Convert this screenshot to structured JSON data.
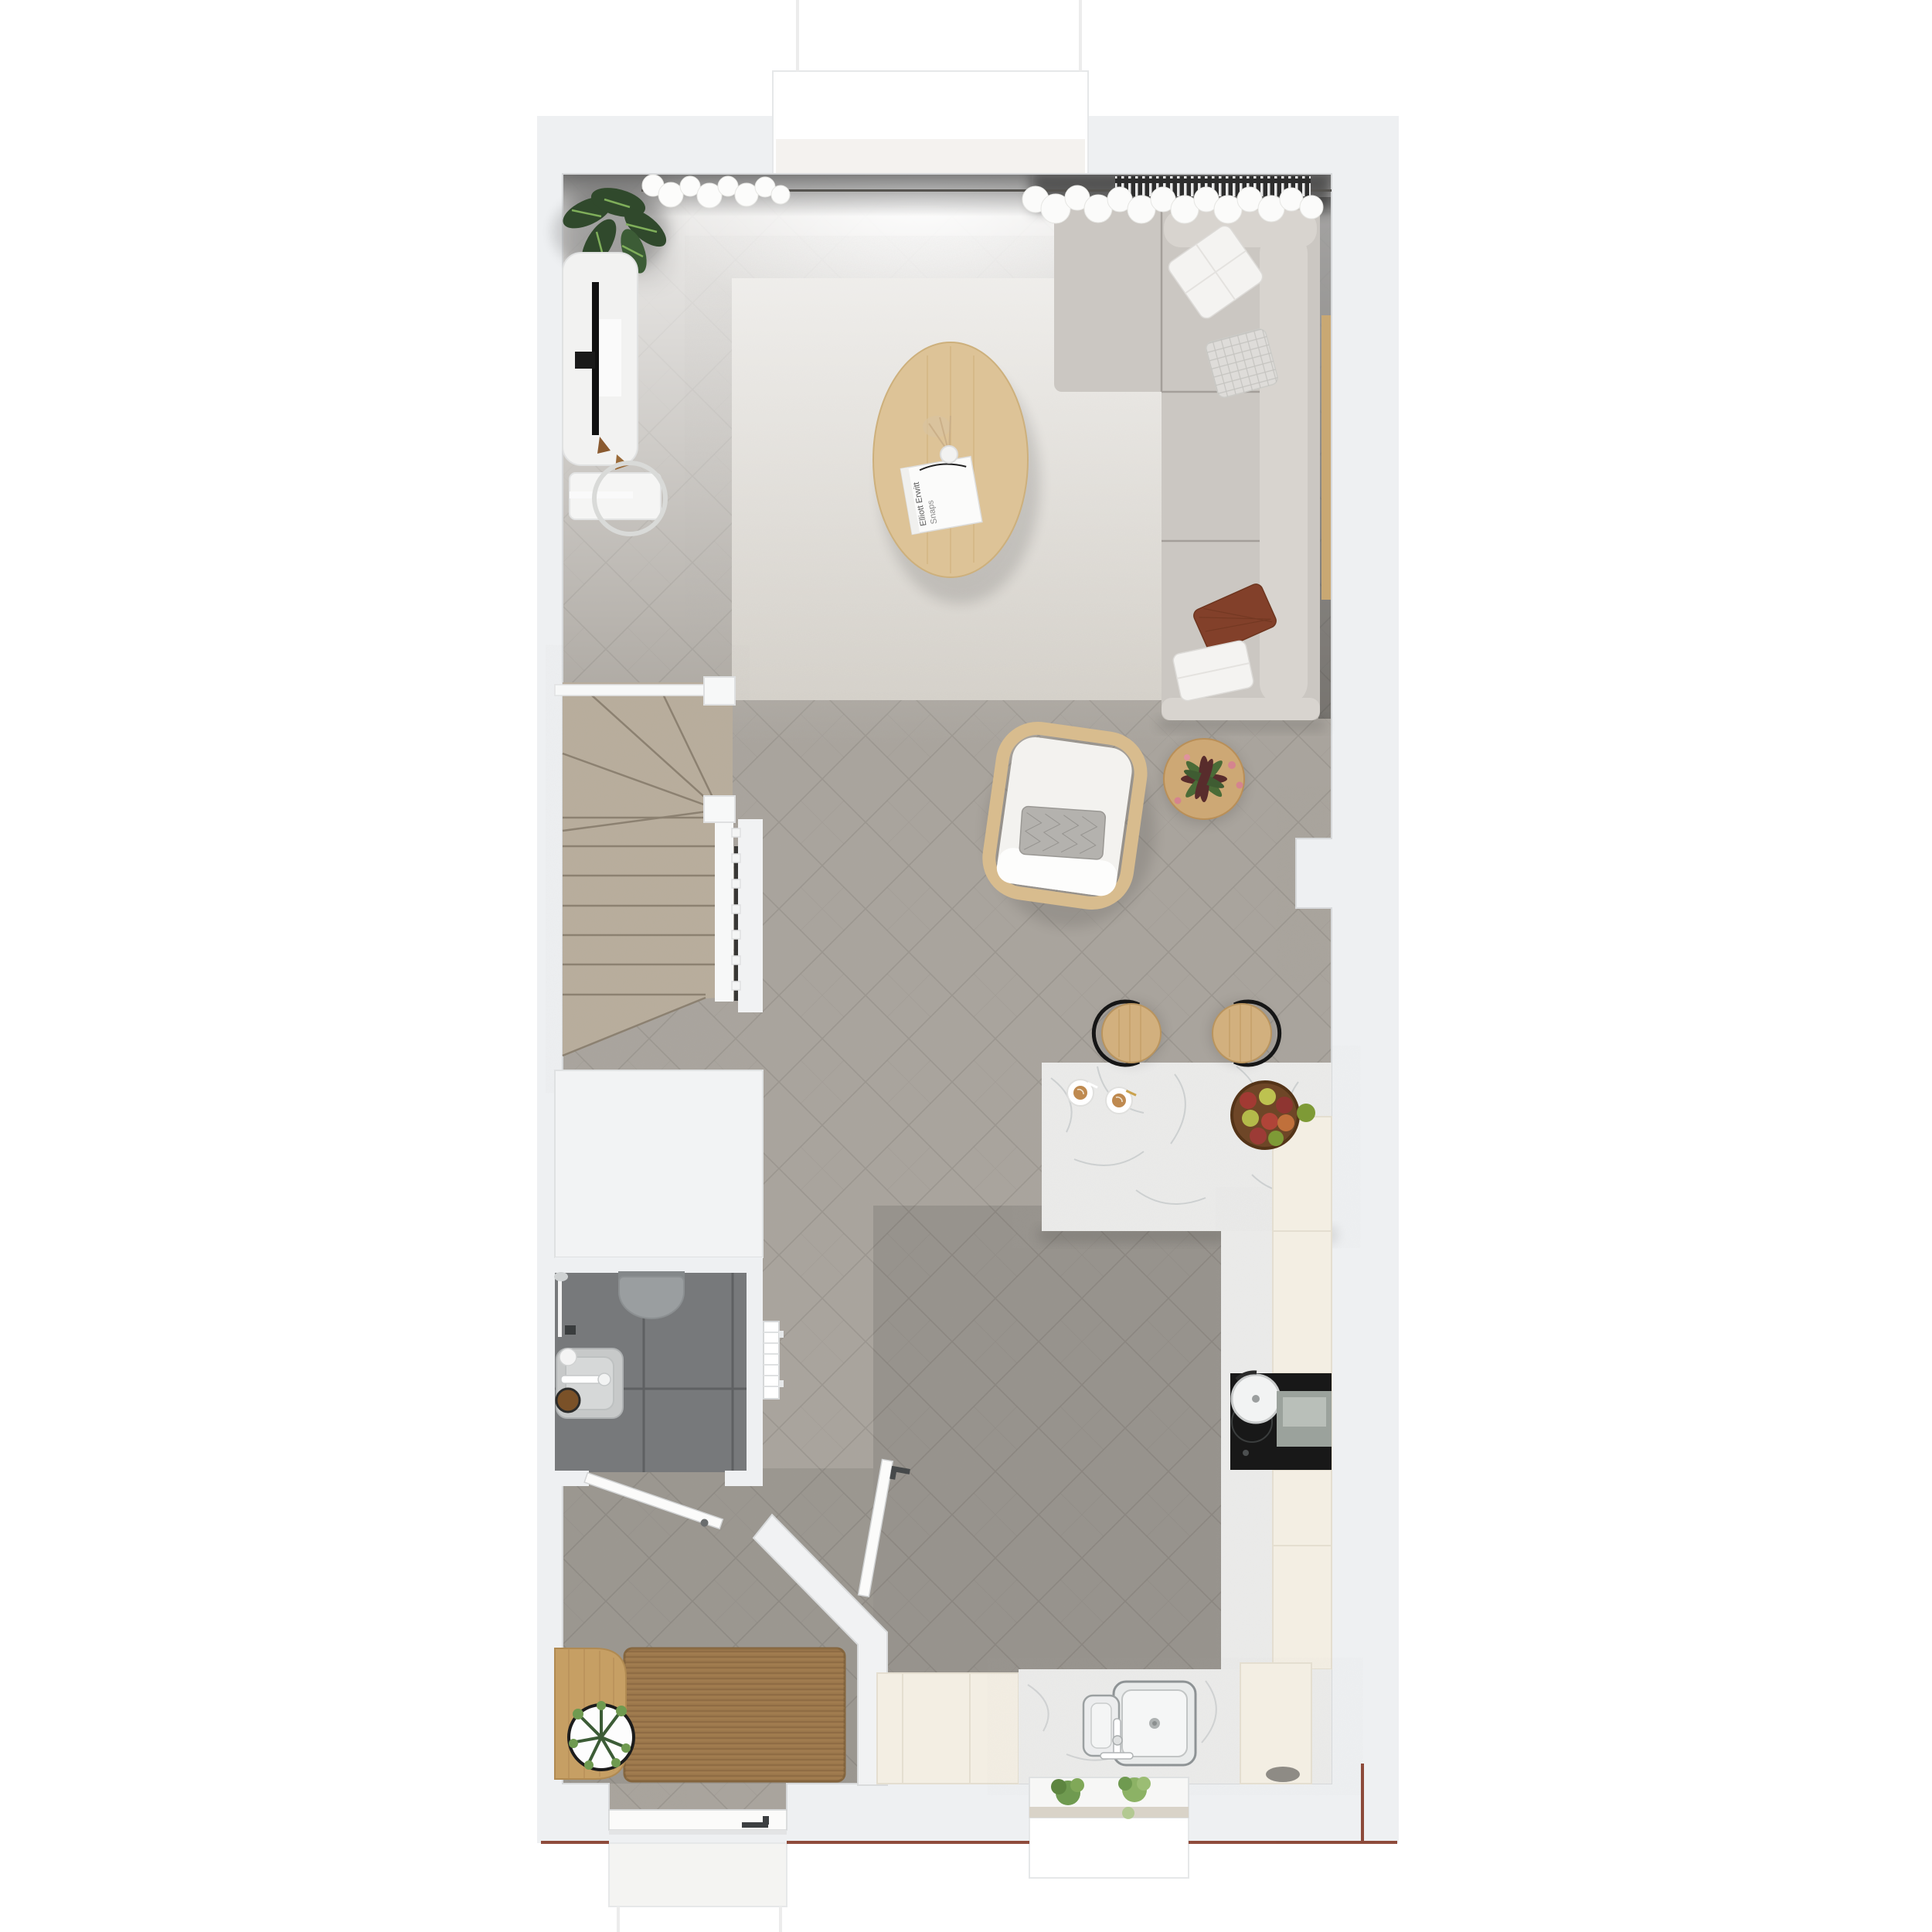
{
  "scene": {
    "kind": "top-down 3D rendered floor plan",
    "floor": "ground floor with living room, open kitchen, hallway, shower room and winder staircase"
  },
  "book": {
    "title_line1": "Elliott Erwitt",
    "title_line2": "Snaps"
  },
  "inventory": {
    "living_room": [
      "corner-sofa",
      "throw-pillows",
      "coffee-table",
      "photo-book",
      "vase-dried-flowers",
      "area-rug",
      "armchair",
      "side-table-with-plant",
      "tv-console",
      "tv",
      "floor-lamp-table",
      "alocasia-plant",
      "curtains",
      "window-radiator"
    ],
    "kitchen": [
      "island-counter",
      "bar-stools",
      "coffee-cups",
      "fruit-bowl",
      "tall-cabinets",
      "cooktop",
      "pot",
      "kitchen-sink",
      "faucet",
      "herb-window-box"
    ],
    "hallway": [
      "doormat",
      "entry-bench",
      "potted-plant",
      "front-door",
      "interior-door",
      "vertical-radiator"
    ],
    "bathroom": [
      "washbasin",
      "toilet",
      "shower-column",
      "tiled-floor",
      "bathroom-door"
    ],
    "staircase": [
      "winder-stairs",
      "handrail",
      "balusters",
      "newel-posts"
    ]
  },
  "colors": {
    "wall": "#eef0f2",
    "wallline": "#d7d9db",
    "bay": "#ffffff",
    "floor": "#a9a49d",
    "floorlight": "#dad7d2",
    "plankline": "#6f6a64",
    "rug": "#d7d3cc",
    "carpet": "#b8ad9c",
    "carpetline": "#8c8171",
    "tile": "#77797b",
    "grout": "#5e6062",
    "sofa": "#cbc7c2",
    "sofalight": "#d8d4cf",
    "sofaseam": "#a49f9a",
    "pillowwhite": "#f4f3f1",
    "pillowplaid": "#dedcd9",
    "pillowrust": "#82402a",
    "pillowgray": "#b4b2ae",
    "oak": "#ddc397",
    "oakdark": "#c2a06d",
    "stoolwood": "#d2b07e",
    "marble": "#ebebea",
    "vein": "#b5b9bb",
    "cream": "#f3eee3",
    "mat": "#9c784c",
    "matline": "#7d5e39",
    "bench": "#c69f64",
    "greendark": "#30492c",
    "green": "#6f9a50",
    "plantred": "#582c2c",
    "tulip": "#d5848f",
    "applered": "#a23a33",
    "applegreen": "#7e9a36",
    "appleyellow": "#bdc250",
    "wicker": "#6e4627",
    "latte": "#bf8a50",
    "gold": "#b78c3f",
    "black": "#181818",
    "appliance": "#9ba29c",
    "steel": "#c9cccd",
    "steeldark": "#8e9395",
    "white": "#ffffff",
    "offwhite": "#f4f4f2",
    "door": "#fbfbfa",
    "frame": "#c9cbcd",
    "radiator": "#2d2d2d",
    "rail": "#f7f8f8",
    "redline": "#7c2e1b",
    "toilet": "#9a9ea0",
    "sink": "#c7c9c9",
    "chrome": "#b7bbbc"
  }
}
